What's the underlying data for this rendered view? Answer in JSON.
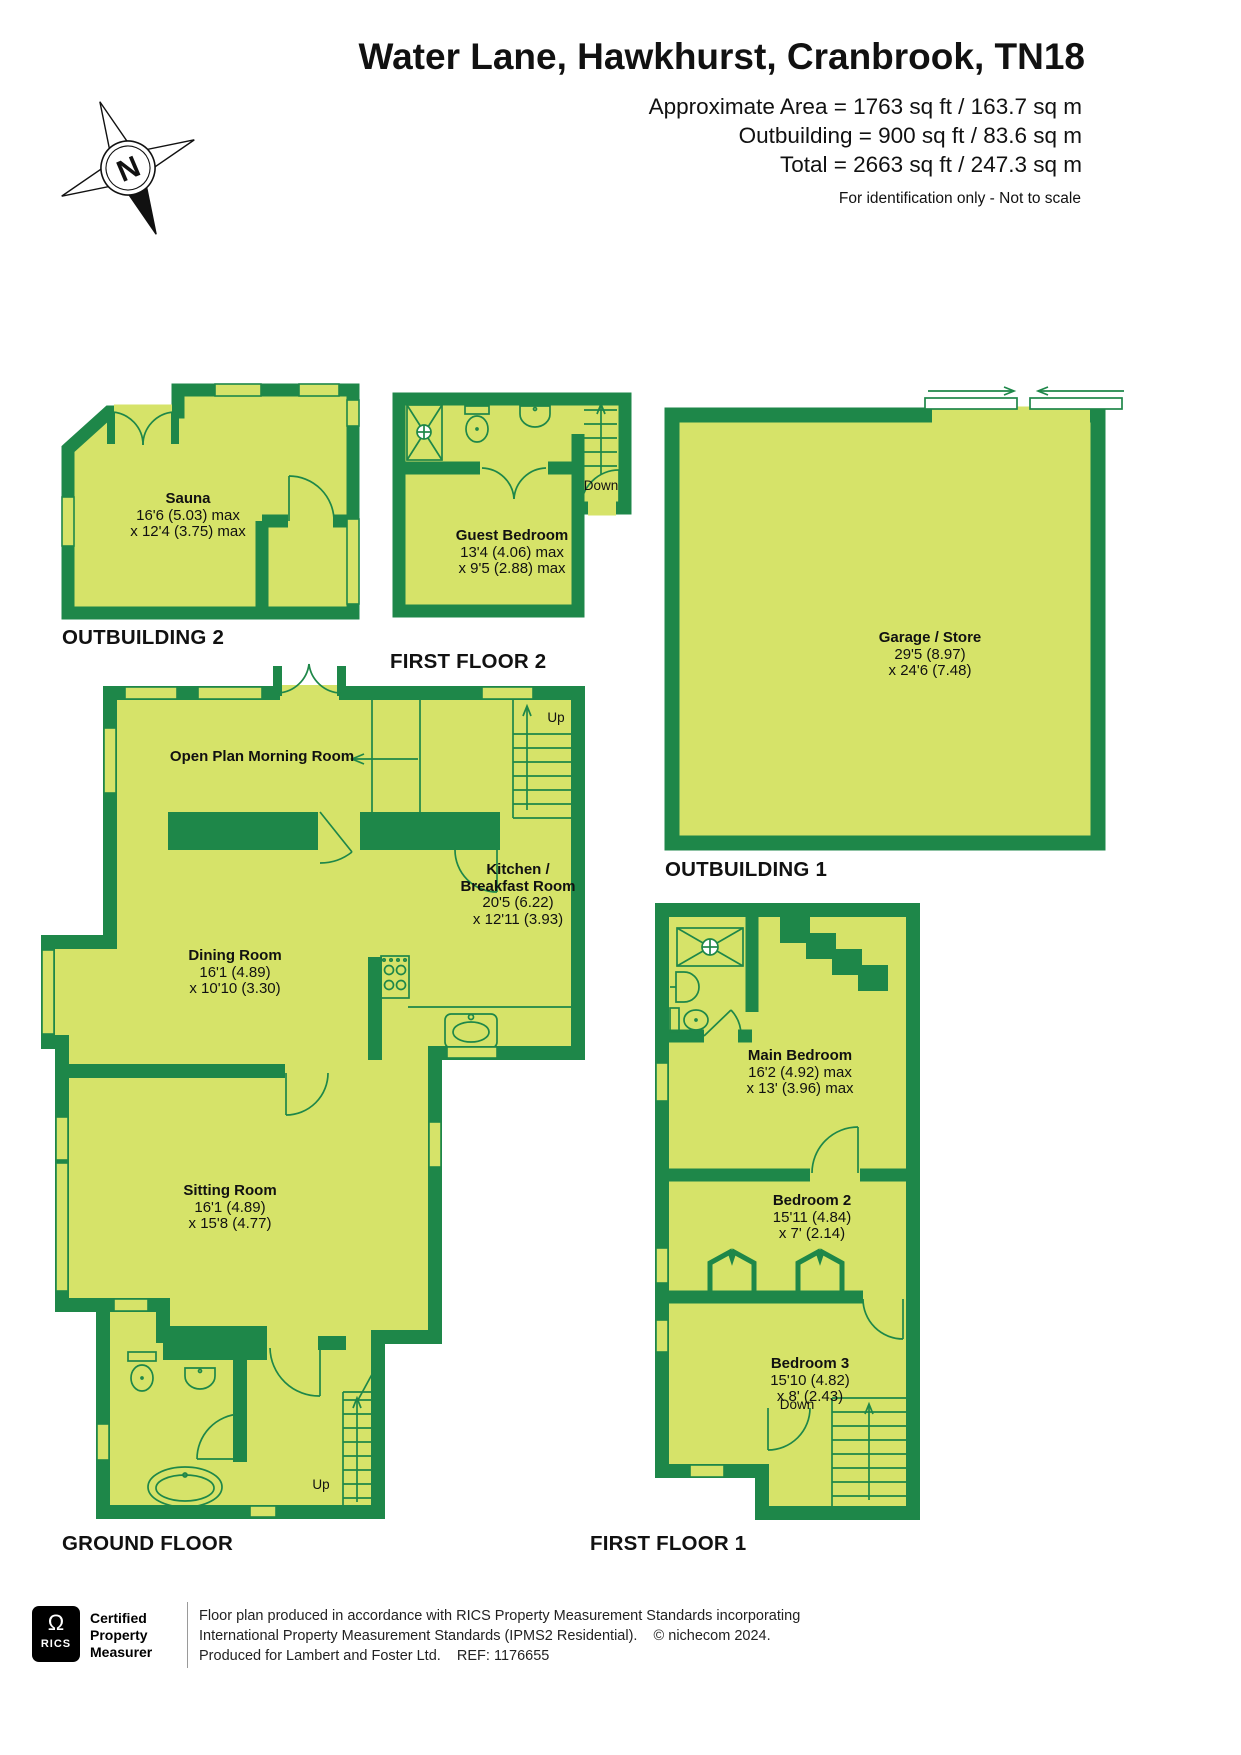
{
  "colors": {
    "wall": "#1e8749",
    "room": "#d6e369",
    "ink": "#111111"
  },
  "header": {
    "title": "Water Lane, Hawkhurst, Cranbrook, TN18",
    "area_lines": [
      "Approximate Area = 1763 sq ft / 163.7 sq m",
      "Outbuilding = 900 sq ft / 83.6 sq m",
      "Total = 2663 sq ft / 247.3 sq m"
    ],
    "note": "For identification only - Not to scale",
    "compass_label": "N"
  },
  "floor_labels": {
    "outbuilding2": "OUTBUILDING 2",
    "first_floor2": "FIRST FLOOR 2",
    "outbuilding1": "OUTBUILDING 1",
    "ground_floor": "GROUND FLOOR",
    "first_floor1": "FIRST FLOOR 1"
  },
  "rooms": {
    "sauna": {
      "name": "Sauna",
      "l1": "16'6 (5.03) max",
      "l2": "x 12'4 (3.75) max"
    },
    "guest_bedroom": {
      "name": "Guest Bedroom",
      "l1": "13'4 (4.06) max",
      "l2": "x 9'5 (2.88)  max"
    },
    "garage": {
      "name": "Garage / Store",
      "l1": "29'5 (8.97)",
      "l2": "x 24'6 (7.48)"
    },
    "morning_room": {
      "name": "Open Plan Morning Room"
    },
    "kitchen": {
      "name": "Kitchen /",
      "name2": "Breakfast Room",
      "l1": "20'5 (6.22)",
      "l2": "x 12'11 (3.93)"
    },
    "dining": {
      "name": "Dining Room",
      "l1": "16'1 (4.89)",
      "l2": "x 10'10 (3.30)"
    },
    "sitting": {
      "name": "Sitting Room",
      "l1": "16'1 (4.89)",
      "l2": "x 15'8 (4.77)"
    },
    "main_bedroom": {
      "name": "Main Bedroom",
      "l1": "16'2 (4.92) max",
      "l2": "x 13' (3.96) max"
    },
    "bedroom2": {
      "name": "Bedroom 2",
      "l1": "15'11 (4.84)",
      "l2": "x 7' (2.14)"
    },
    "bedroom3": {
      "name": "Bedroom 3",
      "l1": "15'10 (4.82)",
      "l2": "x 8' (2.43)"
    }
  },
  "stairs": {
    "first_floor2": "Down",
    "ground_kitchen": "Up",
    "ground_hall": "Up",
    "first_floor1": "Down"
  },
  "footer": {
    "logo_mark": "Ω",
    "logo_text": "RICS",
    "certified_lines": [
      "Certified",
      "Property",
      "Measurer"
    ],
    "lines": [
      "Floor plan produced in accordance with RICS Property Measurement Standards incorporating",
      "International Property Measurement Standards (IPMS2 Residential).    © nichecom 2024.",
      "Produced for Lambert and Foster Ltd.    REF: 1176655"
    ]
  }
}
